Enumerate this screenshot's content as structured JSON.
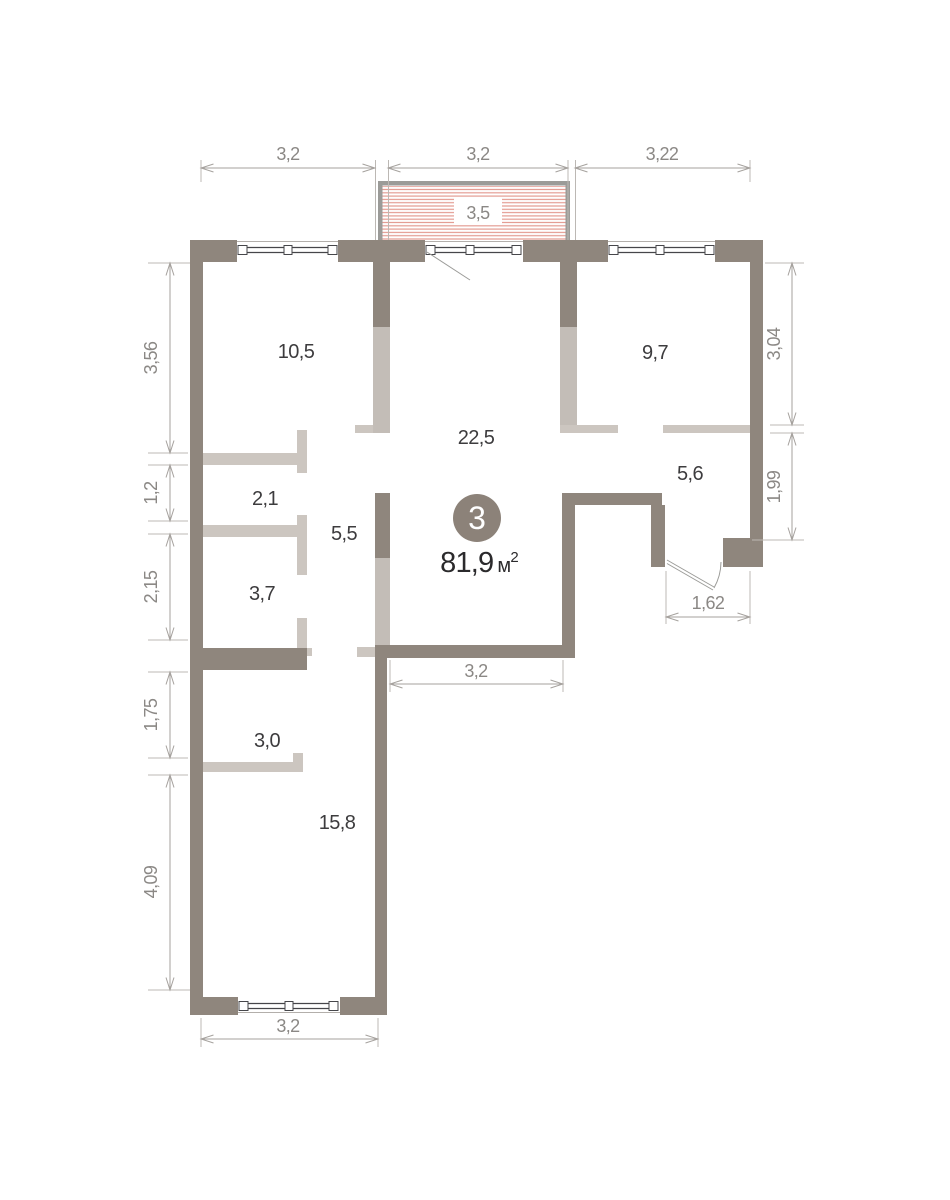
{
  "unit": {
    "number": "3",
    "area_value": "81,9",
    "area_unit": "м",
    "area_sup": "2"
  },
  "rooms": {
    "r105": "10,5",
    "r97": "9,7",
    "r225": "22,5",
    "r56": "5,6",
    "r21": "2,1",
    "r55": "5,5",
    "r37": "3,7",
    "r30": "3,0",
    "r158": "15,8"
  },
  "dims": {
    "top1": "3,2",
    "top2": "3,2",
    "top3": "3,22",
    "balcony": "3,5",
    "left1": "3,56",
    "left2": "1,2",
    "left3": "2,15",
    "left4": "1,75",
    "left5": "4,09",
    "right1": "3,04",
    "right2": "1,99",
    "bottom": "3,2",
    "hall": "3,2",
    "entry": "1,62"
  },
  "colors": {
    "wall_dark": "#8f867d",
    "wall_light": "#ccc6c0",
    "balcony_stripe": "#e49b91",
    "dimension_line": "#a5a19d",
    "dimension_text": "#8b8885",
    "room_text": "#3d3c3e",
    "area_text": "#2b2a2c",
    "unit_circle": "#8c8279"
  }
}
